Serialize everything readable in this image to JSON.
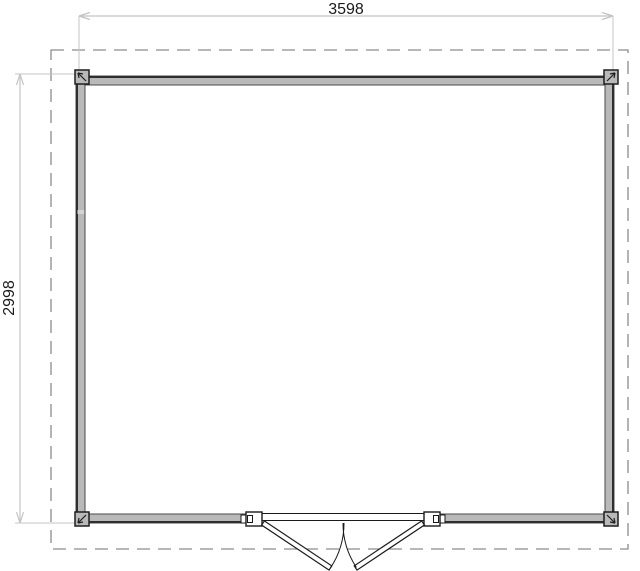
{
  "drawing": {
    "type": "architectural-floor-plan",
    "description": "Top-down floor plan of a rectangular garden building with thick grey exterior walls, four corner posts, a double outward-swinging door centered on the bottom wall, and a dashed roof-overhang outline around the walls",
    "dimensions": {
      "width_label": "3598",
      "height_label": "2998"
    },
    "colors": {
      "background": "#ffffff",
      "dimension_line": "#c4c4c4",
      "dimension_text": "#1a1a1a",
      "dashed_roof_outline": "#8c8c8c",
      "wall_fill": "#b9b9b9",
      "wall_outer_edge": "#2e2e2e",
      "wall_inner_edge": "#4a4a4a",
      "door_line": "#1a1a1a"
    }
  }
}
